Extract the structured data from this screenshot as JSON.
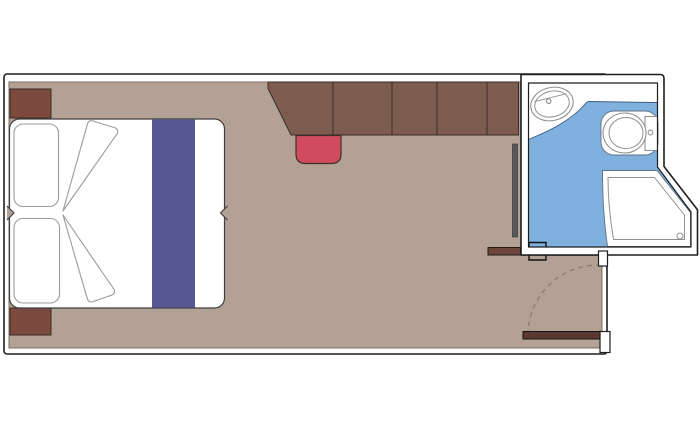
{
  "floor_plan": {
    "type": "cruise-cabin-floor-plan",
    "rooms": [
      {
        "name": "cabin",
        "furniture": [
          "double-bed",
          "pillow-top",
          "pillow-bottom",
          "bed-runner",
          "folded-blanket",
          "nightstand-top",
          "nightstand-bottom",
          "wardrobe-closet-units",
          "desk-unit",
          "stool",
          "wall-mirror-strip",
          "luggage-shelf",
          "entrance-door",
          "door-swing-arc"
        ]
      },
      {
        "name": "bathroom",
        "fixtures": [
          "washbasin",
          "toilet",
          "toilet-cistern",
          "shower-tray",
          "shower-drain",
          "wet-floor-area",
          "bathroom-door-jambs"
        ]
      }
    ]
  },
  "colors": {
    "background": "#ffffff",
    "wall_outline": "#1f1f1f",
    "floor": "#b2a194",
    "floor_edge": "#7d6e5f",
    "wardrobe": "#7d5c50",
    "nightstand": "#7c4a3f",
    "stool": "#d14b5f",
    "bed_runner": "#575893",
    "linen_outline": "#9b9b9b",
    "bathroom_wet_floor": "#7fb0de",
    "wet_floor_edge": "#3c5c7e",
    "fixture_outline": "#8f8f8f",
    "door_leaf": "#5d3a31",
    "shelf": "#6d453a",
    "door_swing_arc": "#8b7b6b",
    "wall_mirror_strip": "#58585a",
    "white": "#ffffff"
  }
}
